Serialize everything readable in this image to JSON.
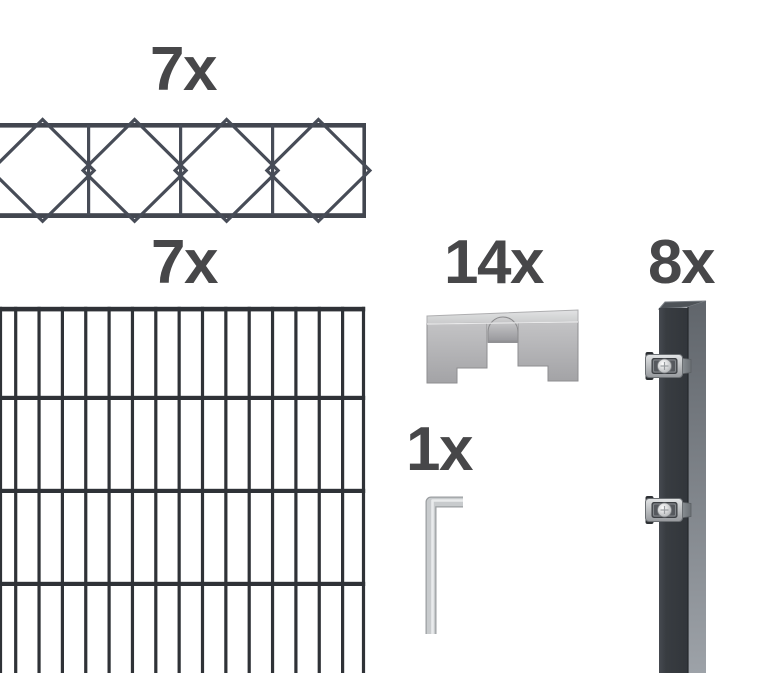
{
  "page": {
    "background": "#ffffff",
    "description_labels_only": true
  },
  "colors": {
    "label_text": "#474749",
    "topper_wire": "#474c57",
    "panel_wire": "#2f3237",
    "post_front": "#383c41",
    "post_side": "#9da2a8",
    "steel_light": "#c8cbcd",
    "steel_mid": "#b0b2b4",
    "steel_dark": "#8f9295"
  },
  "items": {
    "topper": {
      "count": "7x",
      "icon": "decorative-cross-topper-icon"
    },
    "panel": {
      "count": "7x",
      "icon": "double-rod-mesh-panel-icon"
    },
    "clamps": {
      "count": "14x",
      "icon": "cover-rail-clamp-icon"
    },
    "allen_key": {
      "count": "1x",
      "icon": "allen-key-icon"
    },
    "posts": {
      "count": "8x",
      "icon": "fence-post-icon"
    }
  }
}
